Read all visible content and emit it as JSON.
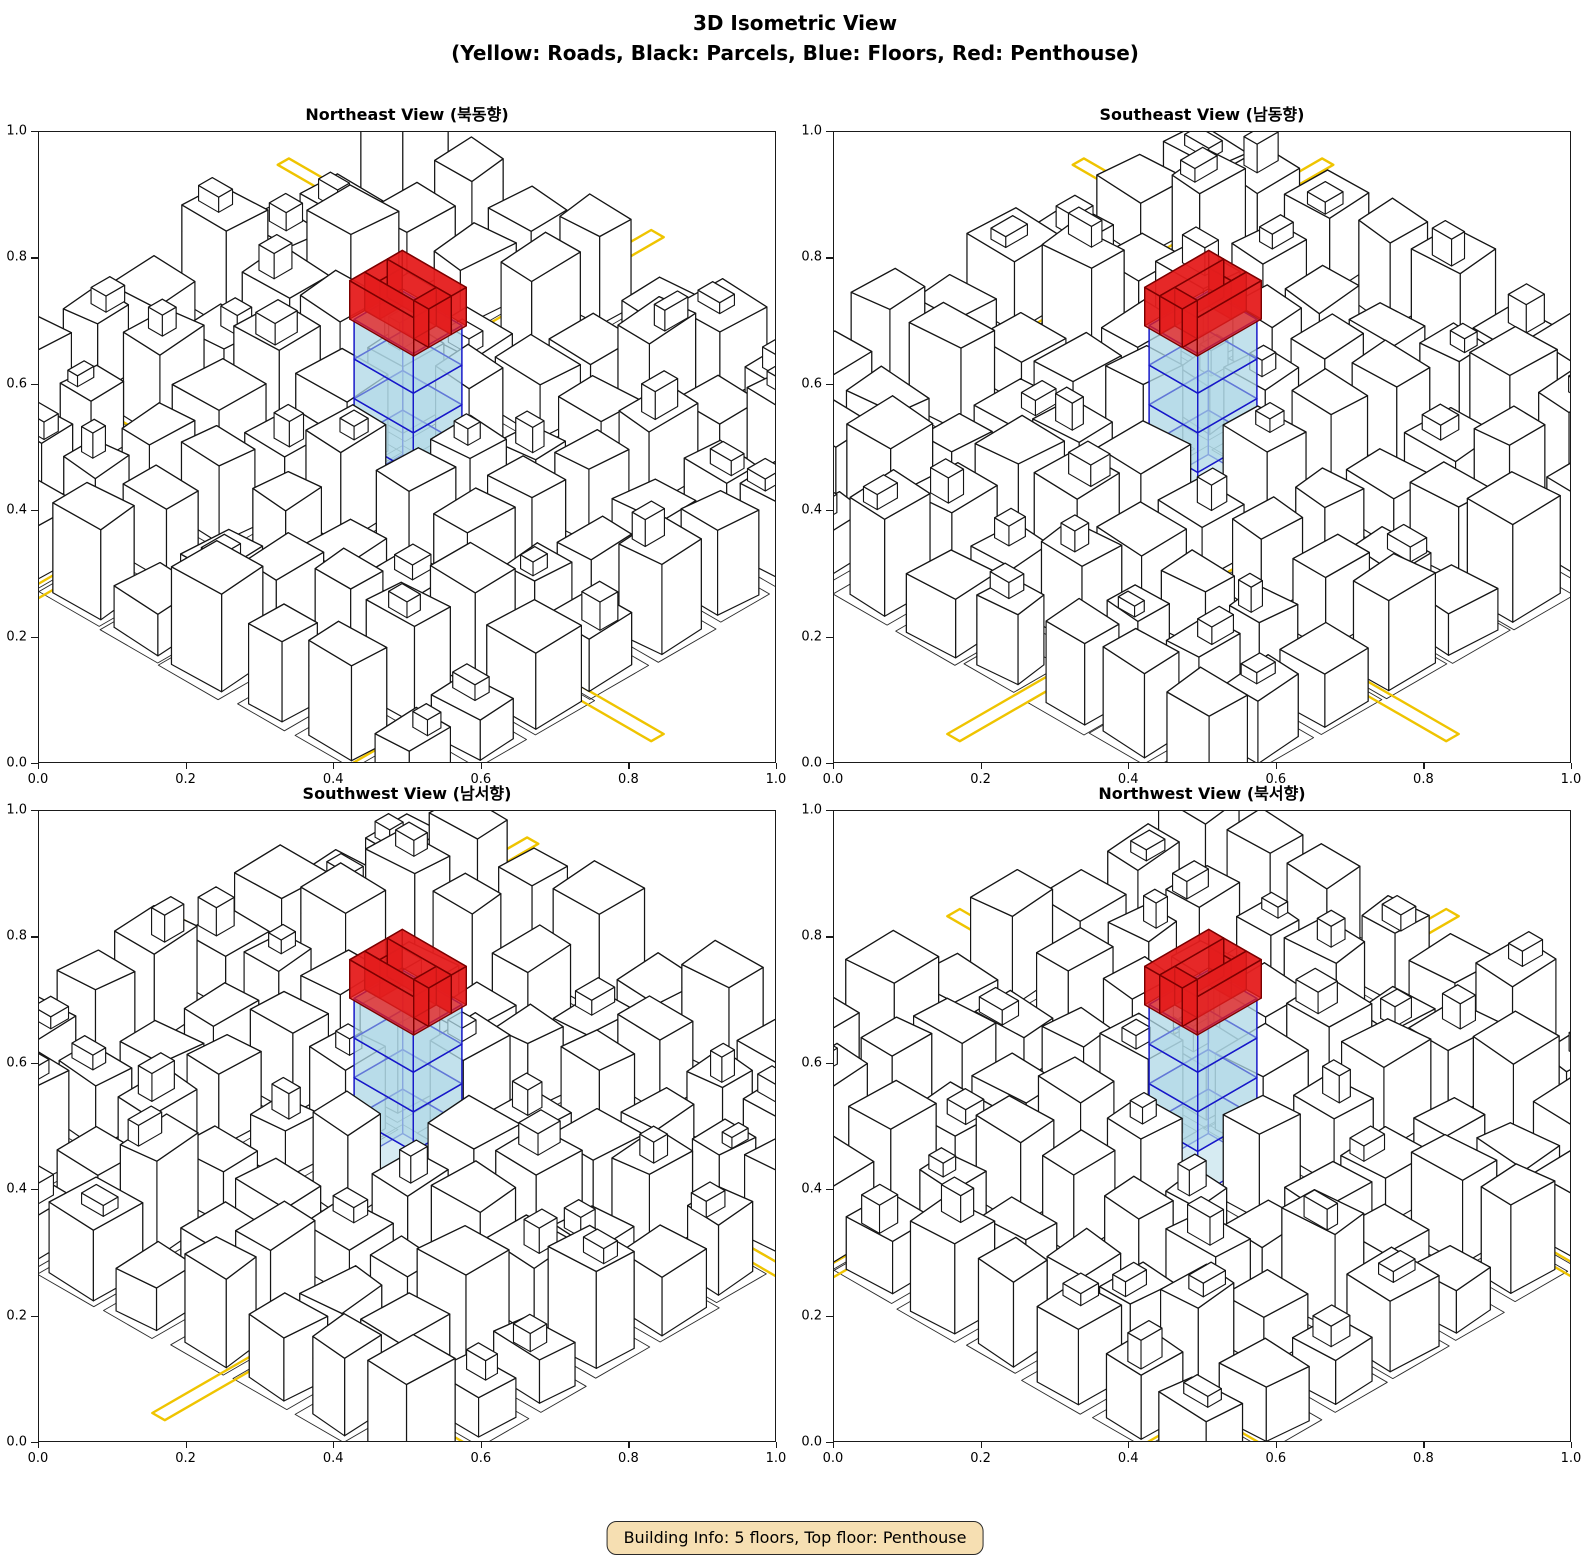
{
  "figure": {
    "title": "3D Isometric View",
    "subtitle": "(Yellow: Roads, Black: Parcels, Blue: Floors, Red: Penthouse)"
  },
  "views": [
    {
      "id": "northeast",
      "title": "Northeast View (북동향)",
      "rotation": 0
    },
    {
      "id": "southeast",
      "title": "Southeast View (남동향)",
      "rotation": 1
    },
    {
      "id": "southwest",
      "title": "Southwest View (남서향)",
      "rotation": 2
    },
    {
      "id": "northwest",
      "title": "Northwest View (북서향)",
      "rotation": 3
    }
  ],
  "axes": {
    "x_ticks": [
      "0.0",
      "0.2",
      "0.4",
      "0.6",
      "0.8",
      "1.0"
    ],
    "y_ticks": [
      "0.0",
      "0.2",
      "0.4",
      "0.6",
      "0.8",
      "1.0"
    ]
  },
  "legend": {
    "roads_color_label": "Yellow",
    "parcels_color_label": "Black",
    "floors_color_label": "Blue",
    "penthouse_color_label": "Red"
  },
  "building_info": {
    "label": "Building Info: 5 floors, Top floor: Penthouse",
    "floors": 5,
    "top_floor": "Penthouse"
  },
  "palette": {
    "building_fill": "#FFFFFF",
    "building_edge": "#161616",
    "parcel_edge": "#2B2B2B",
    "road": "#EFC400",
    "floor_fill": "#ADD8E6",
    "floor_edge": "#1717C9",
    "penthouse_fill": "#E41E1E",
    "penthouse_edge": "#7C0000",
    "info_bg": "#F6DFB2",
    "info_border": "#2A2A2A"
  },
  "chart_data": {
    "type": "3d-isometric",
    "title": "3D Isometric View",
    "subtitle": "(Yellow: Roads, Black: Parcels, Blue: Floors, Red: Penthouse)",
    "subplots": [
      {
        "title": "Northeast View (북동향)",
        "view_direction": "northeast",
        "xlim": [
          0.0,
          1.0
        ],
        "ylim": [
          0.0,
          1.0
        ],
        "xticks": [
          0.0,
          0.2,
          0.4,
          0.6,
          0.8,
          1.0
        ],
        "yticks": [
          0.0,
          0.2,
          0.4,
          0.6,
          0.8,
          1.0
        ]
      },
      {
        "title": "Southeast View (남동향)",
        "view_direction": "southeast",
        "xlim": [
          0.0,
          1.0
        ],
        "ylim": [
          0.0,
          1.0
        ],
        "xticks": [
          0.0,
          0.2,
          0.4,
          0.6,
          0.8,
          1.0
        ],
        "yticks": [
          0.0,
          0.2,
          0.4,
          0.6,
          0.8,
          1.0
        ]
      },
      {
        "title": "Southwest View (남서향)",
        "view_direction": "southwest",
        "xlim": [
          0.0,
          1.0
        ],
        "ylim": [
          0.0,
          1.0
        ],
        "xticks": [
          0.0,
          0.2,
          0.4,
          0.6,
          0.8,
          1.0
        ],
        "yticks": [
          0.0,
          0.2,
          0.4,
          0.6,
          0.8,
          1.0
        ]
      },
      {
        "title": "Northwest View (북서향)",
        "view_direction": "northwest",
        "xlim": [
          0.0,
          1.0
        ],
        "ylim": [
          0.0,
          1.0
        ],
        "xticks": [
          0.0,
          0.2,
          0.4,
          0.6,
          0.8,
          1.0
        ],
        "yticks": [
          0.0,
          0.2,
          0.4,
          0.6,
          0.8,
          1.0
        ]
      }
    ],
    "legend": [
      {
        "label": "Roads",
        "color": "yellow"
      },
      {
        "label": "Parcels",
        "color": "black"
      },
      {
        "label": "Floors",
        "color": "blue"
      },
      {
        "label": "Penthouse",
        "color": "red"
      }
    ],
    "featured_building": {
      "total_floors": 5,
      "blue_floors": 4,
      "top_floor": "Penthouse"
    },
    "annotation": "Building Info: 5 floors, Top floor: Penthouse"
  },
  "scene": {
    "seed": 1377613,
    "grid": 4,
    "cell_px": 72,
    "z_px": 120,
    "center_y_frac": 0.55,
    "offset": [
      0,
      6
    ],
    "featured": {
      "w": 0.95,
      "d": 0.78,
      "floors": 4,
      "floor_h": 0.33,
      "pent_h": 0.32,
      "pent_scale": 1.08,
      "pent_t": 0.24
    },
    "roads": [
      {
        "axis": "x",
        "pos": 1.5,
        "width": 0.2,
        "from": -5.5,
        "to": 5.5
      },
      {
        "axis": "y",
        "pos": -1.5,
        "width": 0.2,
        "from": -5.5,
        "to": 5.5
      },
      {
        "axis": "x",
        "pos": -3.5,
        "width": 0.18,
        "from": -5.5,
        "to": 5.5
      },
      {
        "axis": "y",
        "pos": 3.5,
        "width": 0.18,
        "from": -5.5,
        "to": 5.5
      }
    ]
  }
}
